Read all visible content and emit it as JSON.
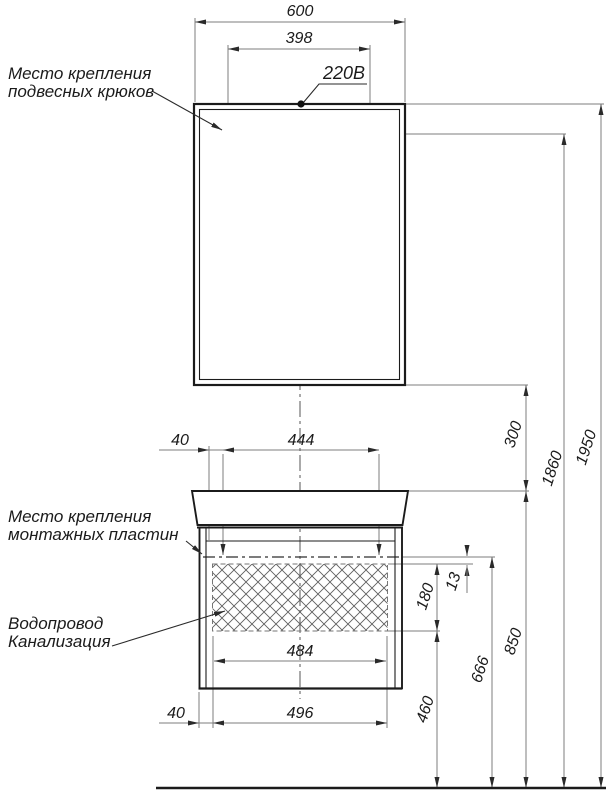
{
  "title": "Схема установки мебели (зеркало и тумба с раковиной)",
  "labels": {
    "hooks_line1": "Место крепления",
    "hooks_line2": "подвесных крюков",
    "plates_line1": "Место крепления",
    "plates_line2": "монтажных пластин",
    "plumbing_line1": "Водопровод",
    "plumbing_line2": "Канализация",
    "power": "220В"
  },
  "dimensions": {
    "mirror_width": "600",
    "hook_span": "398",
    "plate_left_offset": "40",
    "plate_span": "444",
    "service_zone_width": "484",
    "cabinet_left_offset": "40",
    "cabinet_bottom_width": "496",
    "mirror_to_basin_gap": "300",
    "hook_height": "1860",
    "total_height": "1950",
    "plate_to_zone_gap": "13",
    "service_zone_height": "180",
    "service_zone_bottom_height": "460",
    "plate_line_height": "666",
    "basin_top_height": "850"
  },
  "colors": {
    "outline": "#1b1b1b",
    "thin_line": "#7e7e7e",
    "centerline": "#555555",
    "arrow": "#2a2a2a",
    "background": "#ffffff"
  }
}
